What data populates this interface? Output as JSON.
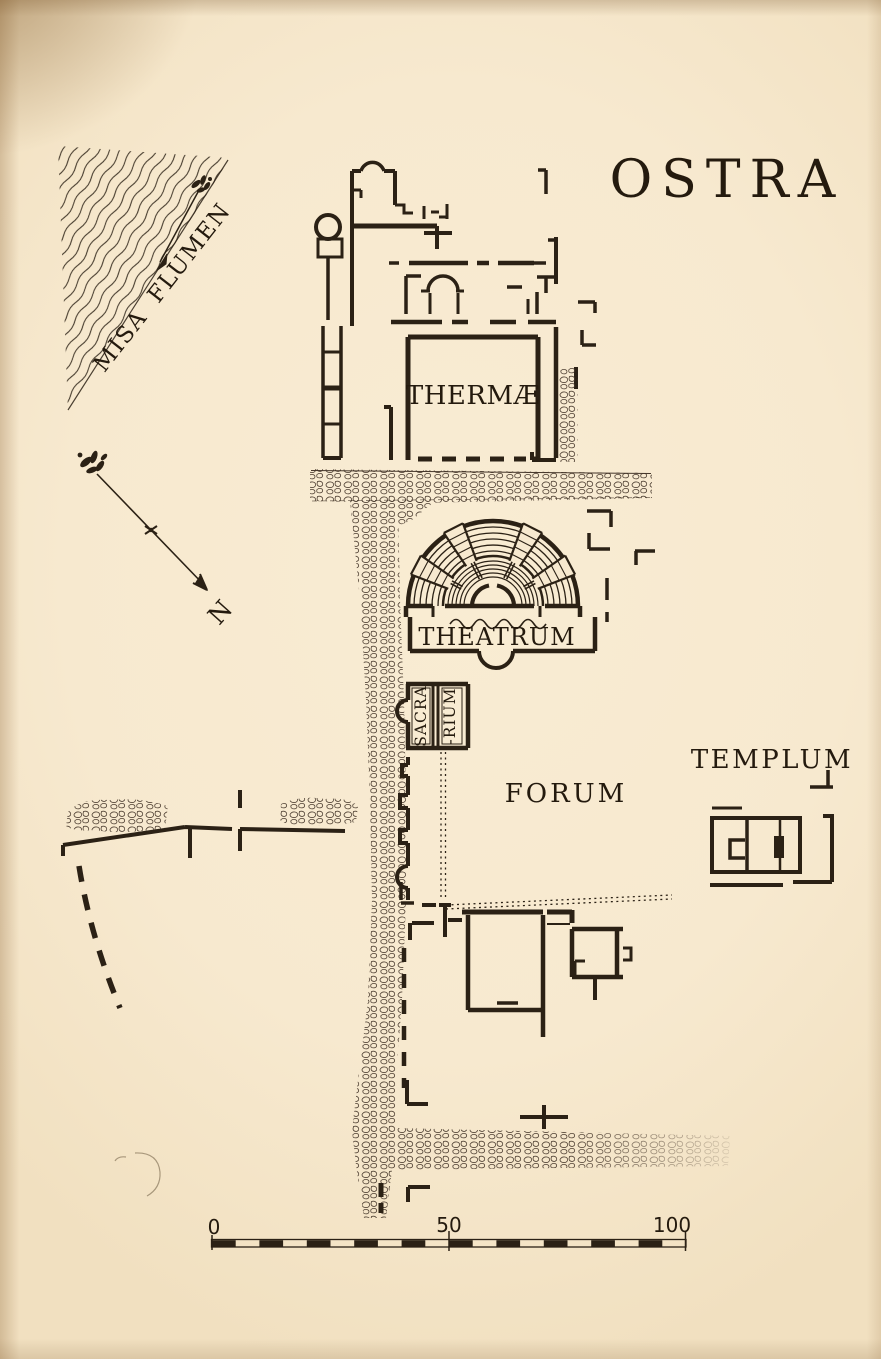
{
  "map": {
    "title": "OSTRA",
    "labels": {
      "river": "MISA FLUMEN",
      "north": "N",
      "baths": "THERMÆ",
      "theater": "THEATRUM",
      "sacrarium_top": "SACRA",
      "sacrarium_bottom": "-RIUM",
      "forum": "FORUM",
      "temple": "TEMPLUM"
    },
    "scale_bar": {
      "tick_0": "0",
      "tick_50": "50",
      "tick_100": "100"
    },
    "colors": {
      "paper": "#f7e9cf",
      "ink": "#2b2115"
    }
  }
}
